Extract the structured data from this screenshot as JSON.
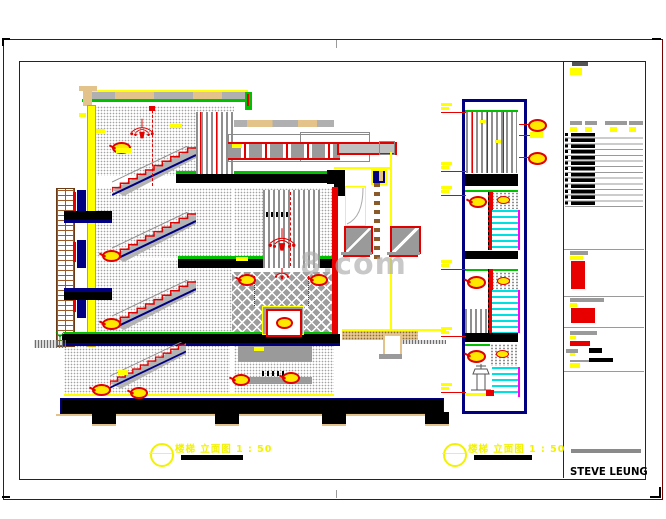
{
  "watermark": {
    "text": "8.com"
  },
  "captions": {
    "main": {
      "text": "楼梯 立面图  1 : 50"
    },
    "detail": {
      "text": "楼梯 立面图  1 : 50"
    }
  },
  "title_block": {
    "brand": "STEVE LEUNG"
  },
  "colors": {
    "frame": "#7a0000",
    "navy": "#000080",
    "green": "#00c000",
    "red": "#e80000",
    "yellow": "#ffff00",
    "cyan": "#00e0e0",
    "magenta": "#ff00ff",
    "tan": "#e3c389",
    "brick": "#9c5a28",
    "gray": "#9a9a9a"
  }
}
